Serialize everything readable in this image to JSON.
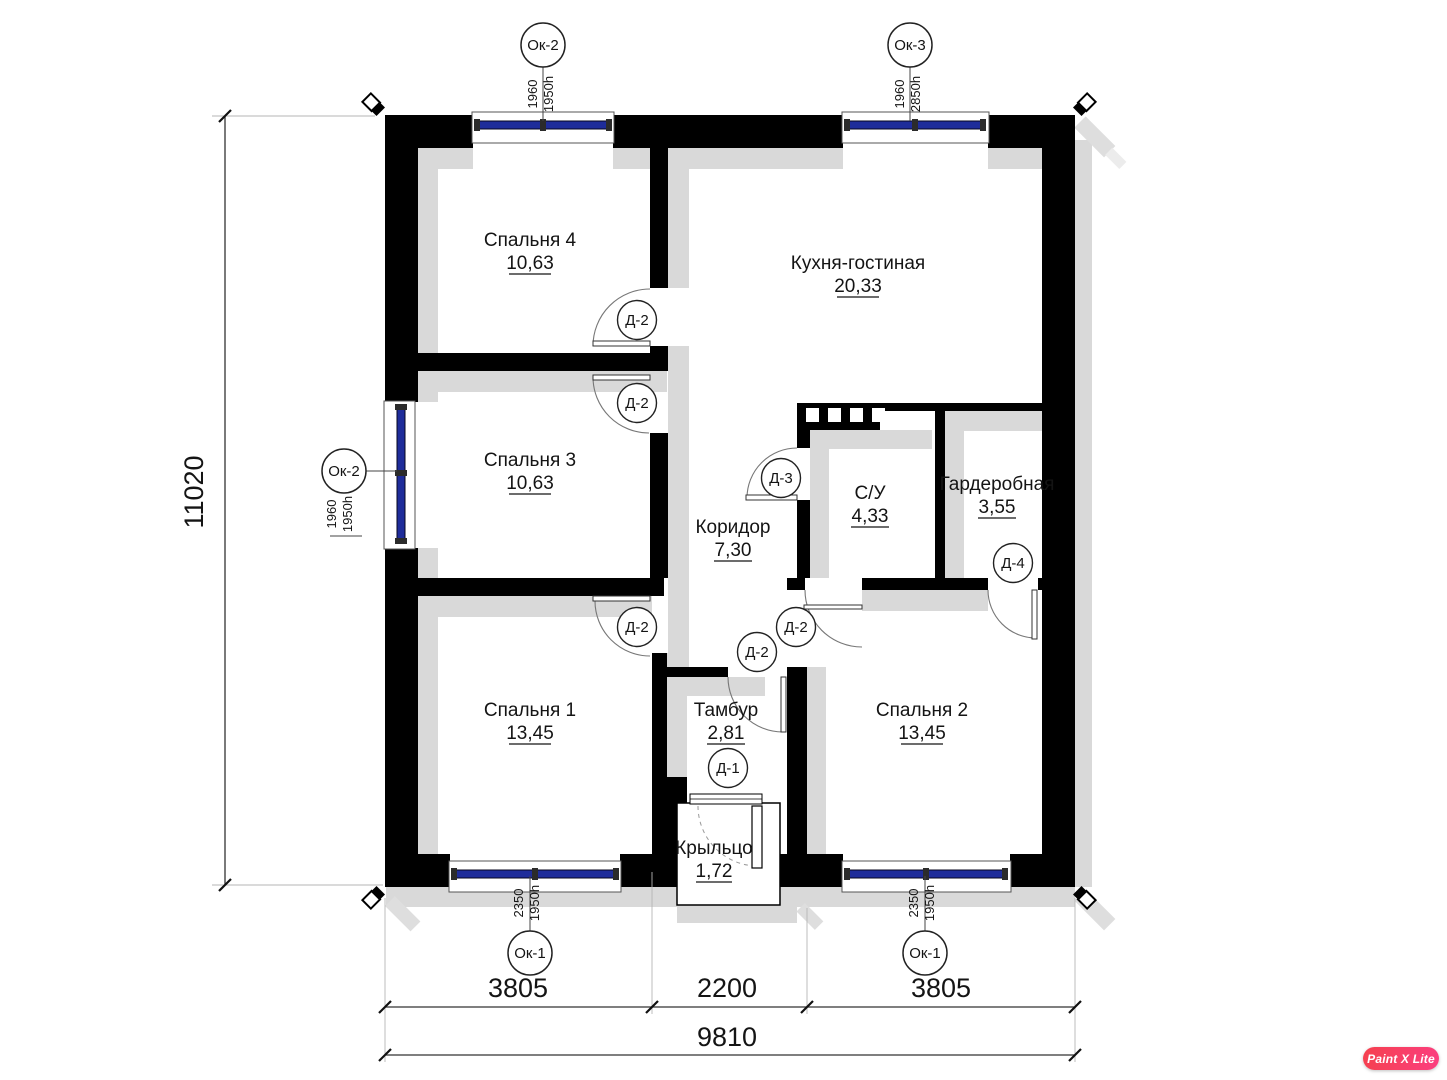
{
  "watermark": {
    "label": "Paint X Lite"
  },
  "rooms": [
    {
      "name": "Спальня 4",
      "area": "10,63"
    },
    {
      "name": "Кухня-гостиная",
      "area": "20,33"
    },
    {
      "name": "Спальня 3",
      "area": "10,63"
    },
    {
      "name": "Коридор",
      "area": "7,30"
    },
    {
      "name": "С/У",
      "area": "4,33"
    },
    {
      "name": "Гардеробная",
      "area": "3,55"
    },
    {
      "name": "Спальня 1",
      "area": "13,45"
    },
    {
      "name": "Тамбур",
      "area": "2,81"
    },
    {
      "name": "Спальня 2",
      "area": "13,45"
    },
    {
      "name": "Крыльцо",
      "area": "1,72"
    }
  ],
  "windows": [
    {
      "tag": "Ок-2",
      "width_mm": "1960",
      "height_mm": "1950h"
    },
    {
      "tag": "Ок-3",
      "width_mm": "1960",
      "height_mm": "2850h"
    },
    {
      "tag": "Ок-2",
      "width_mm": "1960",
      "height_mm": "1950h"
    },
    {
      "tag": "Ок-1",
      "width_mm": "2350",
      "height_mm": "1950h"
    },
    {
      "tag": "Ок-1",
      "width_mm": "2350",
      "height_mm": "1950h"
    }
  ],
  "doors": [
    {
      "tag": "Д-2"
    },
    {
      "tag": "Д-2"
    },
    {
      "tag": "Д-3"
    },
    {
      "tag": "Д-4"
    },
    {
      "tag": "Д-2"
    },
    {
      "tag": "Д-2"
    },
    {
      "tag": "Д-2"
    },
    {
      "tag": "Д-1"
    }
  ],
  "dimensions": {
    "height_total": "11020",
    "width_segments": [
      "3805",
      "2200",
      "3805"
    ],
    "width_total": "9810"
  }
}
